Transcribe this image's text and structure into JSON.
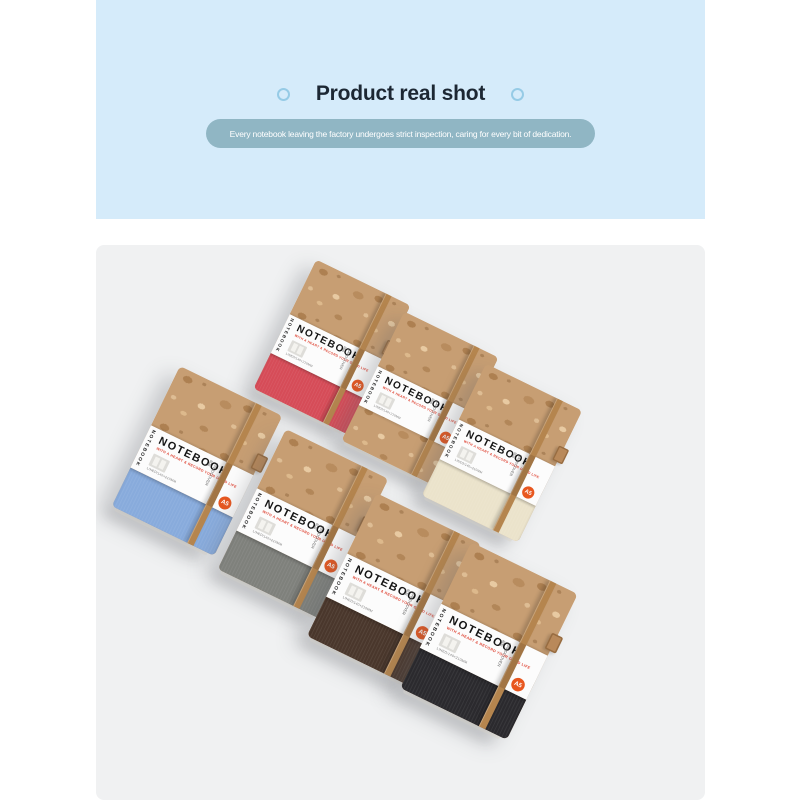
{
  "header": {
    "title": "Product real shot",
    "banner": "Every notebook leaving the factory undergoes strict inspection, caring for every bit of dedication.",
    "colors": {
      "panel_bg": "#d5ebfa",
      "title_text": "#1c2733",
      "ring_stroke": "#96cbe6",
      "banner_bg": "#90b6c4",
      "banner_text": "#ffffff"
    }
  },
  "photo": {
    "background": "#f0f1f2",
    "label": {
      "title": "NOTEBOOK",
      "subtitle": "WITH A HEART & RECORD YOUR GOOD LIFE",
      "spine_text": "NOTEBOOK",
      "spec": "LINED/140×210MM",
      "material": "HARDCOVER",
      "weight": "80g",
      "badge": "A5",
      "badge_color": "#e8571f",
      "subtitle_color": "#e04a3a"
    },
    "band_color": "#b5854e",
    "cork_color": "#c79e73",
    "notebooks": [
      {
        "name": "red",
        "fabric": "#d64c58"
      },
      {
        "name": "cork",
        "fabric": null
      },
      {
        "name": "cream",
        "fabric": "#ebe3cb"
      },
      {
        "name": "blue",
        "fabric": "#88abdc"
      },
      {
        "name": "gray",
        "fabric": "#7f817c"
      },
      {
        "name": "coffee",
        "fabric": "#4a372c"
      },
      {
        "name": "black",
        "fabric": "#2b2a2e"
      }
    ]
  }
}
